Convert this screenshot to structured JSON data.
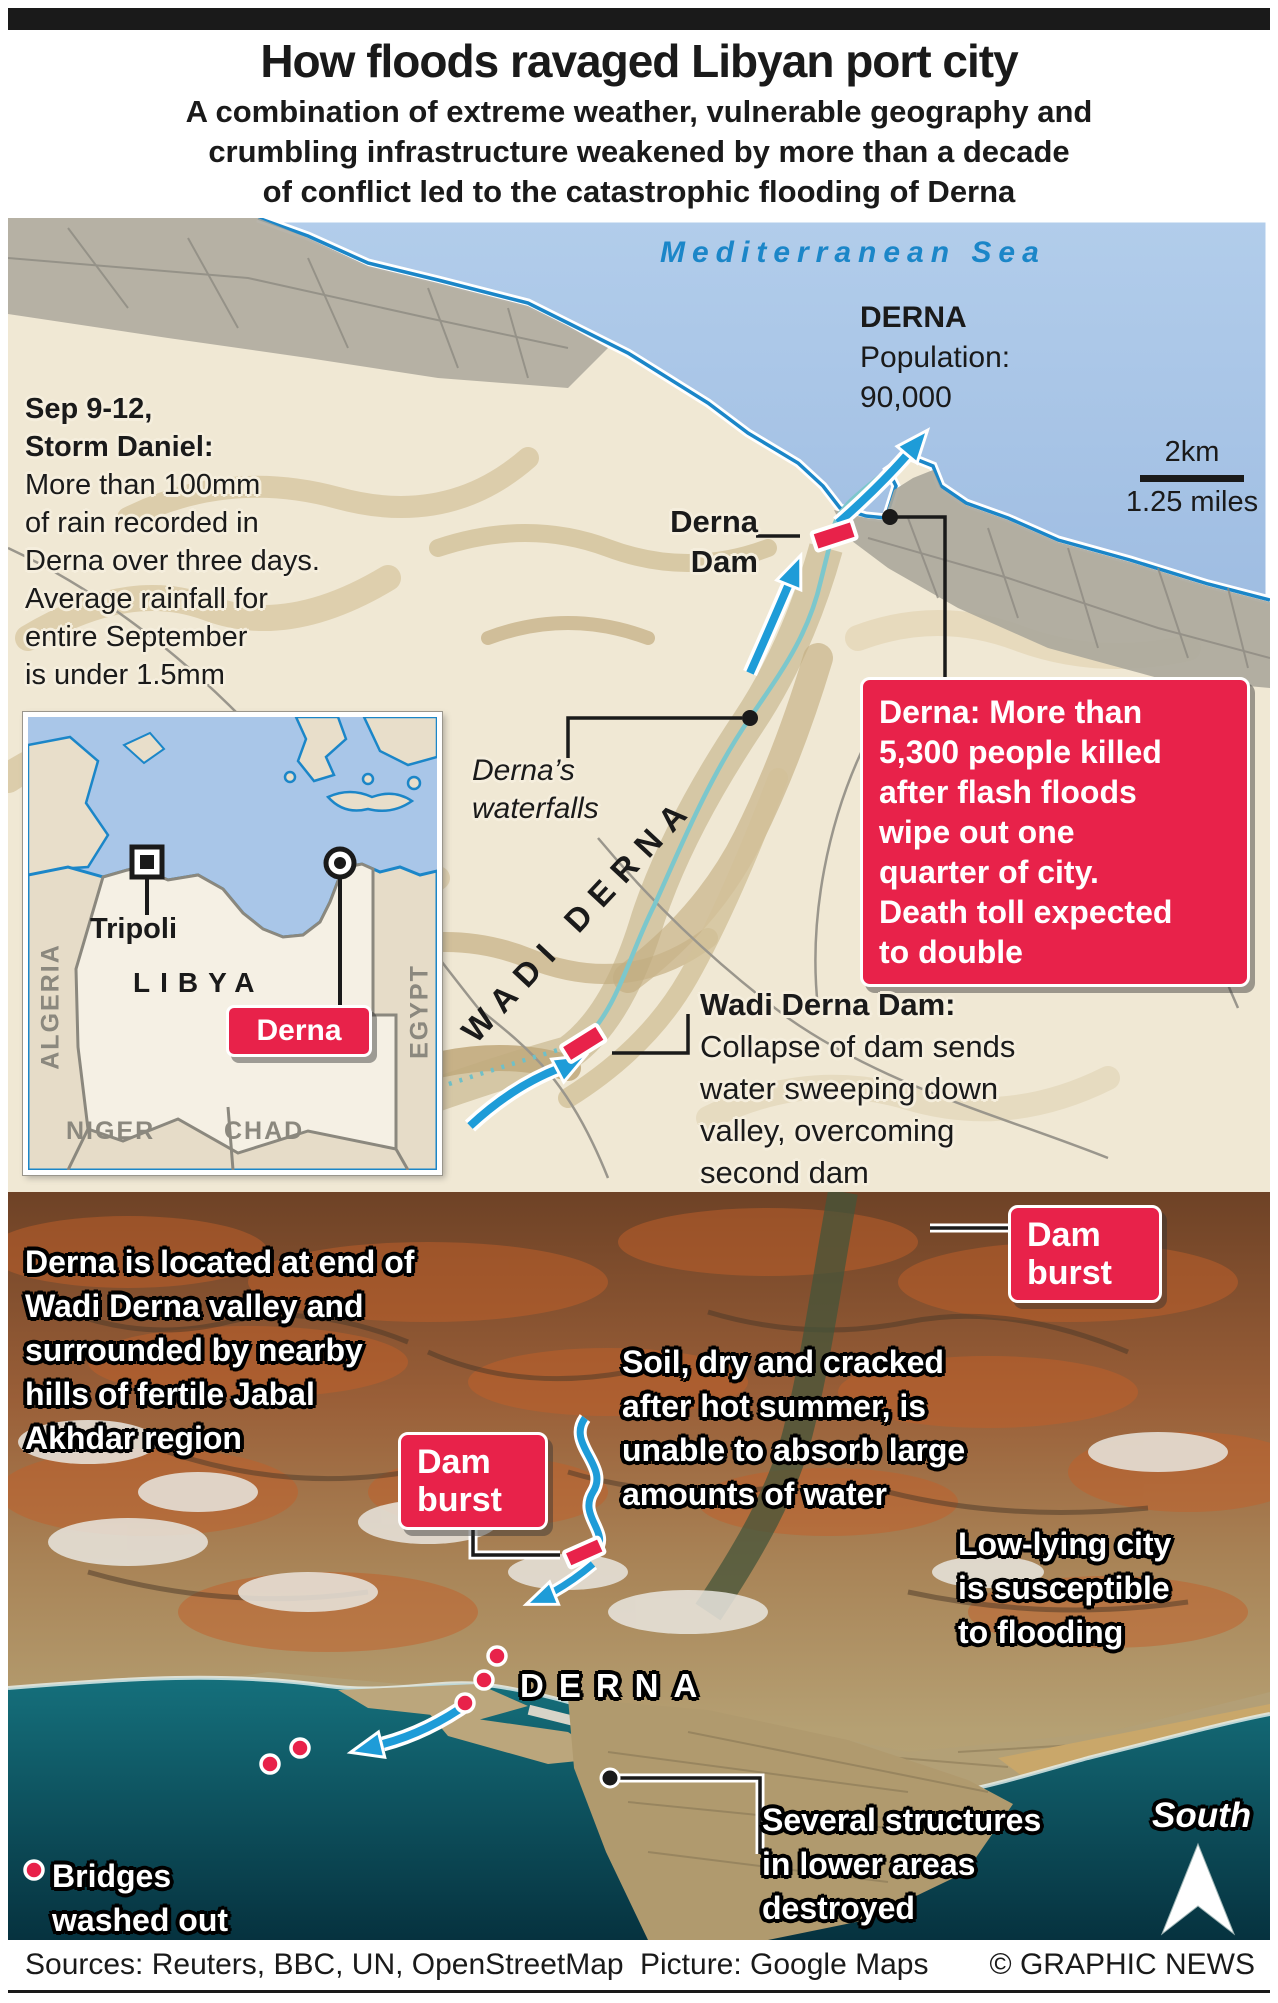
{
  "header": {
    "title": "How floods ravaged Libyan port city",
    "subtitle_lines": [
      "A combination of extreme weather, vulnerable geography and",
      "crumbling infrastructure weakened by more than a decade",
      "of conflict led to the catastrophic flooding of Derna"
    ]
  },
  "map": {
    "sea_label": "Mediterranean Sea",
    "city_name": "DERNA",
    "city_population_lines": [
      "Population:",
      "90,000"
    ],
    "scale_km": "2km",
    "scale_miles": "1.25 miles",
    "storm_note_bold_lines": [
      "Sep 9-12,",
      "Storm Daniel:"
    ],
    "storm_note_lines": [
      "More than 100mm",
      "of rain recorded in",
      "Derna over three days.",
      "Average rainfall for",
      "entire September",
      "is under 1.5mm"
    ],
    "derna_dam_label_lines": [
      "Derna",
      "Dam"
    ],
    "waterfalls_label_lines": [
      "Derna’s",
      "waterfalls"
    ],
    "wadi_label": "WADI DERNA",
    "killed_callout_lines": [
      "Derna: More than",
      "5,300 people killed",
      "after flash floods",
      "wipe out one",
      "quarter of city.",
      "Death toll expected",
      "to double"
    ],
    "wadi_dam_note_bold": "Wadi Derna Dam:",
    "wadi_dam_note_lines": [
      "Collapse of dam sends",
      "water sweeping down",
      "valley, overcoming",
      "second dam"
    ],
    "inset": {
      "libya": "LIBYA",
      "algeria": "ALGERIA",
      "egypt": "EGYPT",
      "niger": "NIGER",
      "chad": "CHAD",
      "tripoli": "Tripoli",
      "derna": "Derna"
    }
  },
  "photo": {
    "location_note_lines": [
      "Derna is located at end of",
      "Wadi Derna valley and",
      "surrounded by nearby",
      "hills of fertile Jabal",
      "Akhdar region"
    ],
    "dam_burst_lines": [
      "Dam",
      "burst"
    ],
    "soil_note_lines": [
      "Soil, dry and cracked",
      "after hot summer, is",
      "unable to absorb large",
      "amounts of water"
    ],
    "lowlying_note_lines": [
      "Low-lying city",
      "is susceptible",
      "to flooding"
    ],
    "city_label": "DERNA",
    "structures_note_lines": [
      "Several structures",
      "in lower areas",
      "destroyed"
    ],
    "bridges_note_lines": [
      "Bridges",
      "washed out"
    ],
    "south_label": "South"
  },
  "footer": {
    "sources": "Sources: Reuters, BBC, UN, OpenStreetMap",
    "picture": "Picture: Google Maps",
    "credit": "© GRAPHIC NEWS"
  },
  "colors": {
    "accent_red": "#e8224a",
    "flow_blue": "#1e9cd8",
    "map_sea": "#a9c6e8",
    "map_land": "#f0e8d4",
    "coast_blue": "#1b86c8",
    "photo_sea": "#0d5f6b"
  }
}
